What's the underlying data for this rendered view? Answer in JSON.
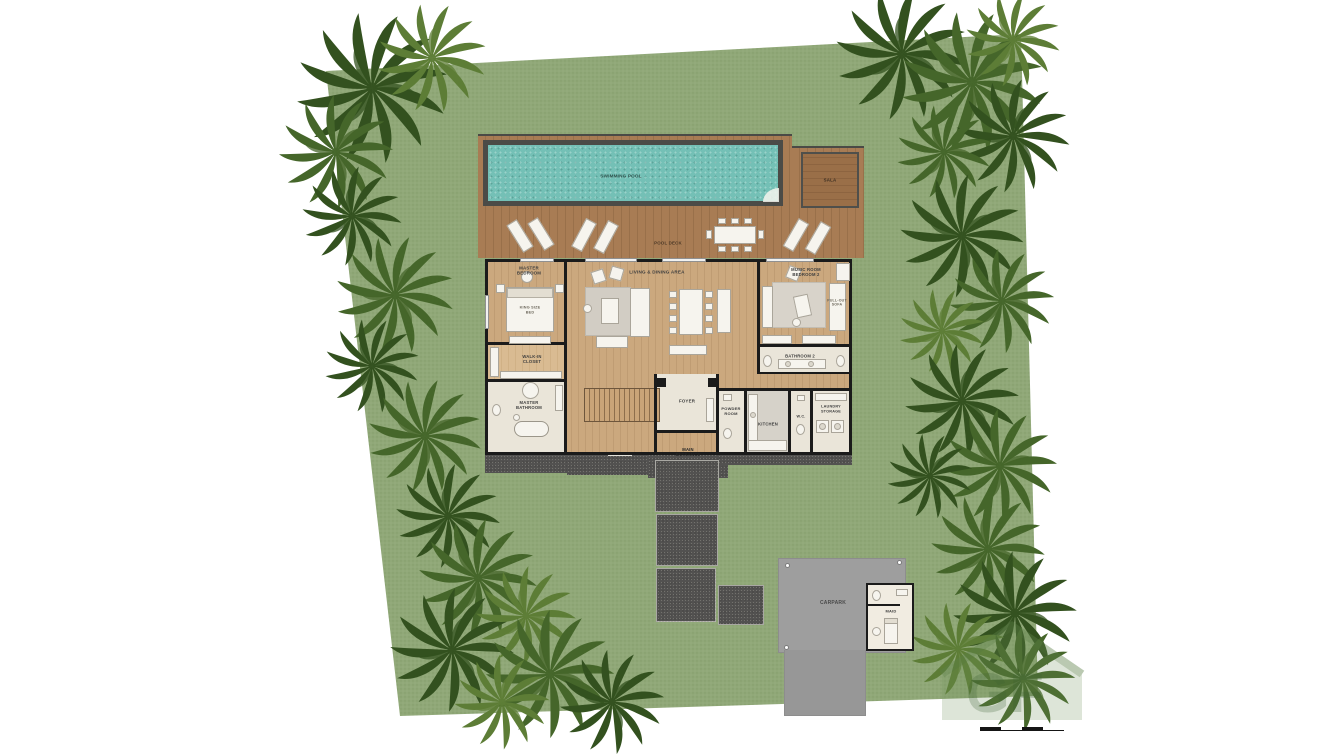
{
  "title": "villa-ground-floor-site-plan",
  "labels": {
    "swimming_pool": "SWIMMING POOL",
    "sala": "SALA",
    "pool_deck": "POOL DECK",
    "master_bedroom": "MASTER BEDROOM",
    "king_size_bed": "KING SIZE BED",
    "walk_in_closet": "WALK-IN CLOSET",
    "master_bathroom": "MASTER BATHROOM",
    "living_dining_area": "LIVING & DINING AREA",
    "music_room_bedroom_2": "MUSIC ROOM BEDROOM 2",
    "pull_out_sofa": "PULL-OUT SOFA",
    "bathroom_2": "BATHROOM 2",
    "foyer": "FOYER",
    "main_entrance": "MAIN ENTRANCE",
    "powder_room": "POWDER ROOM",
    "kitchen": "KITCHEN",
    "wc": "W.C.",
    "laundry_storage": "LAUNDRY STORAGE",
    "carpark": "CARPARK",
    "maid": "MAID"
  },
  "watermark": {
    "letters": "GF"
  },
  "colors": {
    "lawn": "#90a878",
    "lawn_dot": "#849c6b",
    "palm_dark": "#33511f",
    "palm_mid": "#45662a",
    "palm_light": "#5d7d36",
    "deck_wood": "#a87c54",
    "deck_wood_dark": "#99704a",
    "pool_water": "#74c0b6",
    "pool_frame": "#4b4b47",
    "house_wood": "#cba87e",
    "house_wood_dark": "#bf9c73",
    "bath_floor": "#eae5d9",
    "gravel": "#525150",
    "carpark_gray": "#9e9e9e",
    "wall": "#1b1b1b",
    "furniture_white": "#f6f4ee",
    "watermark_green": "#5c8047"
  }
}
